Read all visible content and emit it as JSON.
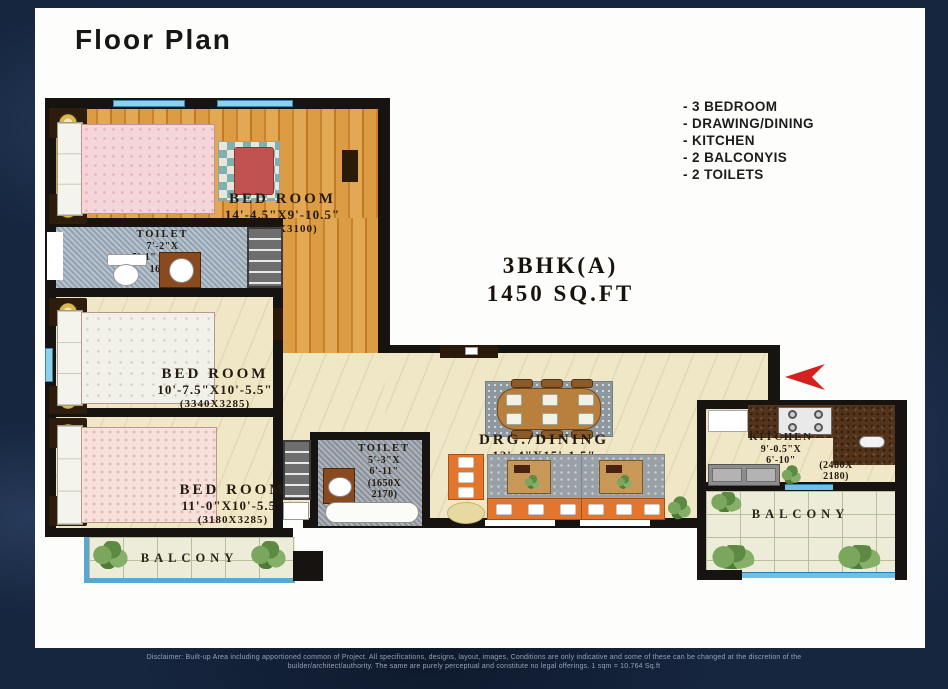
{
  "header": {
    "title": "Floor Plan"
  },
  "features": [
    "- 3 BEDROOM",
    "- DRAWING/DINING",
    "- KITCHEN",
    "- 2 BALCONYIS",
    "- 2 TOILETS"
  ],
  "summary": {
    "unit": "3BHK(A)",
    "area": "1450 SQ.FT"
  },
  "rooms": {
    "bedroom1": {
      "name": "BED ROOM",
      "dim": "14'-4.5\"X9'-10.5\"",
      "mm": "(4505X3100)"
    },
    "toilet1": {
      "name": "TOILET",
      "line1": "7'-2\"X",
      "line2": "5'-1\" (2250X",
      "line3": "1600)"
    },
    "bedroom2": {
      "name": "BED ROOM",
      "dim": "10'-7.5\"X10'-5.5\"",
      "mm": "(3340X3285)"
    },
    "bedroom3": {
      "name": "BED ROOM",
      "dim": "11'-0\"X10'-5.5\"",
      "mm": "(3180X3285)"
    },
    "toilet2": {
      "name": "TOILET",
      "line1": "5'-3\"X",
      "line2": "6'-11\"",
      "mm1": "(1650X",
      "mm2": "2170)"
    },
    "dining": {
      "name": "DRG./DINING",
      "dim": "12'-4\"X15'-1.5\"",
      "mm": "(3865X4740)"
    },
    "kitchen": {
      "name": "KITCHEN",
      "line1": "9'-0.5\"X",
      "line2": "6'-10\"",
      "mm1": "(2480X",
      "mm2": "2180)"
    },
    "balcony_left": {
      "name": "BALCONY"
    },
    "balcony_right": {
      "name": "BALCONY"
    }
  },
  "footer": {
    "line1": "Disclaimer: Built-up Area including apportioned common of Project. All specifications, designs, layout, images, Conditions are only indicative and some of these can be changed at the discretion of the",
    "line2": "builder/architect/authority. The same are purely perceptual and constitute no legal offerings. 1 sqm = 10.764 Sq.ft"
  },
  "colors": {
    "background_navy": "#16263f",
    "wall_black": "#161310",
    "wood_floor": "#dc9c44",
    "cream_floor": "#f0e7c6",
    "window_blue": "#8fd0ec",
    "sofa_orange": "#e2762e",
    "entrance_arrow_red": "#d62020",
    "balcony_edge_blue": "#5aa7cf"
  }
}
